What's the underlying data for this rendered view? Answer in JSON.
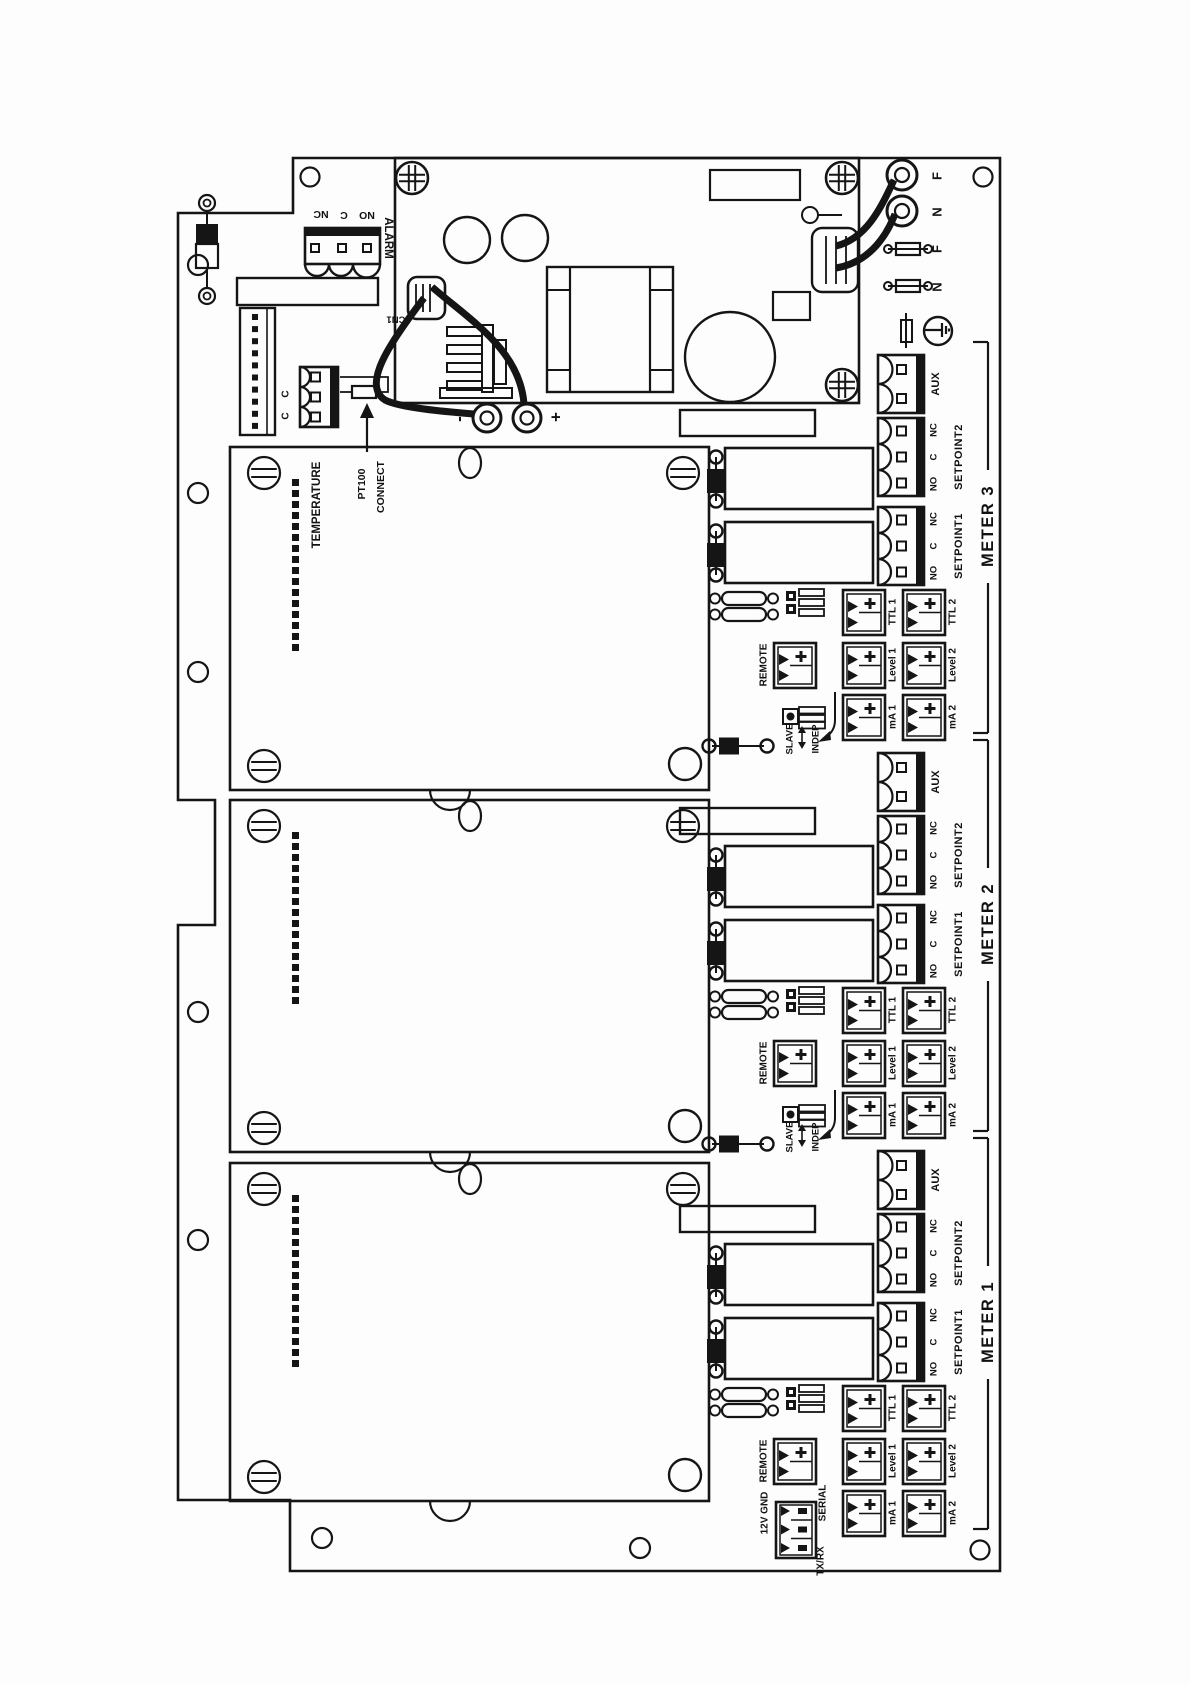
{
  "diagram": {
    "alarm": {
      "label": "ALARM",
      "terminals": [
        "NC",
        "C",
        "NO"
      ],
      "connector_ref": "CN1"
    },
    "mains": {
      "line_terminal": "F",
      "neutral_terminal": "N",
      "line_fuse": "F",
      "neutral_fuse": "N",
      "dc_minus": "-",
      "dc_plus": "+"
    },
    "temperature": {
      "label": "TEMPERATURE",
      "terminals": [
        "C",
        "C"
      ],
      "note_line1": "PT100",
      "note_line2": "CONNECT"
    },
    "io": {
      "aux": "AUX",
      "setpoint1": "SETPOINT1",
      "setpoint2": "SETPOINT2",
      "relay_terminals": [
        "NC",
        "C",
        "NO"
      ],
      "ttl1": "TTL 1",
      "ttl2": "TTL 2",
      "level1": "Level 1",
      "level2": "Level 2",
      "ma1": "mA 1",
      "ma2": "mA 2",
      "remote": "REMOTE",
      "slave": "SLAVE",
      "indep": "INDEP"
    },
    "serial": {
      "power_label": "12V GND",
      "port_label": "SERIAL",
      "txrx_label": "TX/RX"
    },
    "meters": [
      {
        "name": "METER 3"
      },
      {
        "name": "METER 2"
      },
      {
        "name": "METER 1"
      }
    ]
  }
}
